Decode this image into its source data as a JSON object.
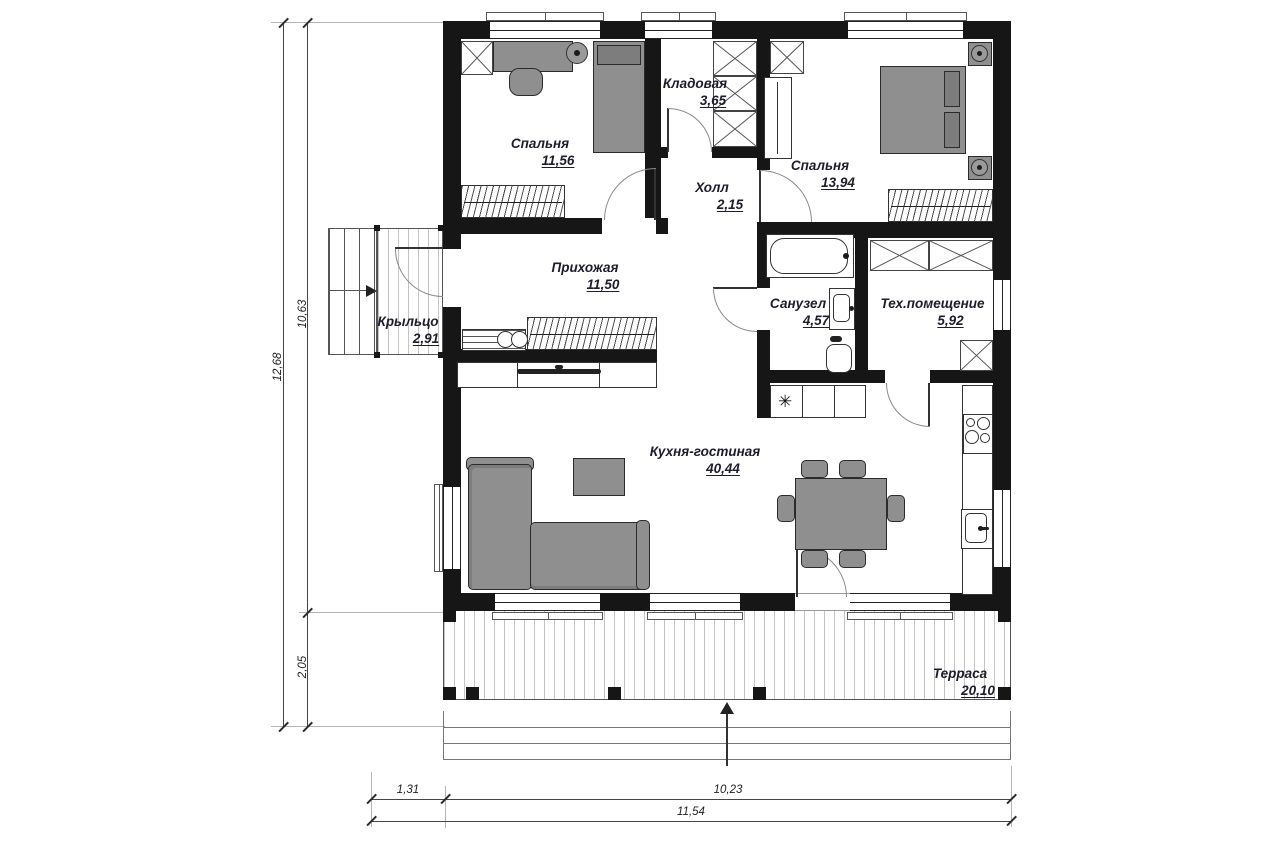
{
  "rooms": [
    {
      "name": "Спальня",
      "area": "11,56"
    },
    {
      "name": "Кладовая",
      "area": "3,65"
    },
    {
      "name": "Холл",
      "area": "2,15"
    },
    {
      "name": "Спальня",
      "area": "13,94"
    },
    {
      "name": "Прихожая",
      "area": "11,50"
    },
    {
      "name": "Крыльцо",
      "area": "2,91"
    },
    {
      "name": "Санузел",
      "area": "4,57"
    },
    {
      "name": "Тех.помещение",
      "area": "5,92"
    },
    {
      "name": "Кухня-гостиная",
      "area": "40,44"
    },
    {
      "name": "Терраса",
      "area": "20,10"
    }
  ],
  "dimensions": {
    "left_total": "12,68",
    "left_upper": "10,63",
    "left_lower": "2,05",
    "bottom_left": "1,31",
    "bottom_main": "10,23",
    "bottom_total": "11,54"
  },
  "symbols": {
    "refrigerator": "✳"
  },
  "colors": {
    "wall": "#161616",
    "furniture": "#8f8f8f",
    "label_text": "#1d1d2b",
    "dim_text": "#222222"
  }
}
